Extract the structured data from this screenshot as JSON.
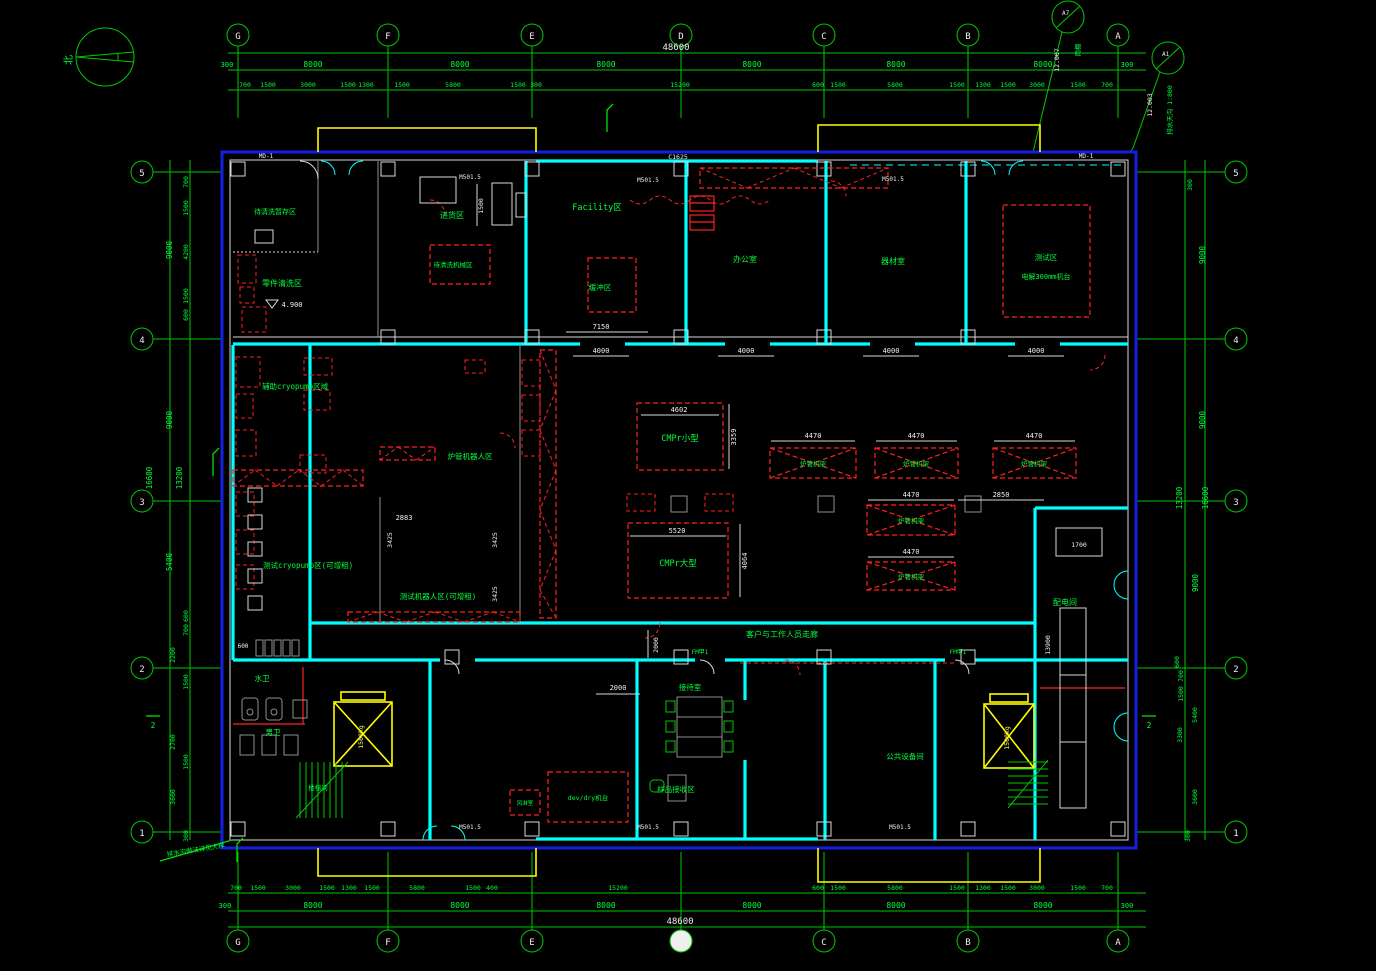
{
  "compass": {
    "north": "北"
  },
  "grid": {
    "letters": [
      "G",
      "F",
      "E",
      "D",
      "C",
      "B",
      "A"
    ],
    "numbers": [
      "5",
      "4",
      "3",
      "2",
      "1"
    ]
  },
  "dims": {
    "v300": "300",
    "v400": "400",
    "v600": "600",
    "v700": "700",
    "v1100": "1100",
    "v1300": "1300",
    "v1500": "1500",
    "v1700": "1700",
    "v2000": "2000",
    "v2200": "2200",
    "v2700": "2700",
    "v2850": "2850",
    "v2883": "2883",
    "v3000": "3000",
    "v3300": "3300",
    "v3359": "3359",
    "v3425": "3425",
    "v3600": "3600",
    "v4000": "4000",
    "v4064": "4064",
    "v4200": "4200",
    "v4470": "4470",
    "v4602": "4602",
    "v4900": "4.900",
    "v5400": "5400",
    "v5520": "5520",
    "v5800": "5800",
    "v7150": "7150",
    "v8000": "8000",
    "v9000": "9000",
    "v13200": "13200",
    "v13900": "13900",
    "v15200": "15200",
    "v16600": "16600",
    "v48600": "48600",
    "c1625": "C1625"
  },
  "rooms": {
    "staging_room": "待清洗暂存区",
    "staging_box": "待清洗机械区",
    "parts_cleaning": "零件清洗区",
    "receiving": "进货区",
    "facility": "Facility区",
    "buffer": "缓冲区",
    "office": "办公室",
    "equipment": "器材室",
    "test": "测试区",
    "electrolysis": "电解300mm机台",
    "aux_cryo": "辅助cryopump区域",
    "tube_robot": "炉管机器人区",
    "test_cryo": "测试cryopump区(可增租)",
    "test_robot": "测试机器人区(可增租)",
    "cmpr_small": "CMPr小型",
    "cmpr_large": "CMPr大型",
    "tube_rack": "炉管机架",
    "power": "配电间",
    "corridor": "客户与工作人员走廊",
    "reception": "接待室",
    "sample": "样品接收区",
    "public_equip": "公共设备间",
    "toilet_w": "水卫",
    "toilet_m": "男卫",
    "devdry": "dev/dry机台",
    "air_shower": "风淋室",
    "stair": "楼梯间",
    "elevator": "1500kg"
  },
  "markers": {
    "m1": {
      "code": "A7",
      "level": "12.007",
      "note": "雨棚"
    },
    "m2": {
      "code": "A1",
      "level": "12.003",
      "note": "排水天沟 1:800"
    }
  },
  "tags": {
    "door": "MD-1",
    "wall": "M501.5",
    "fire_door": "FM甲1"
  },
  "sections": {
    "cut": "2"
  },
  "notes": {
    "drain": "排水沟做法详见大样"
  }
}
